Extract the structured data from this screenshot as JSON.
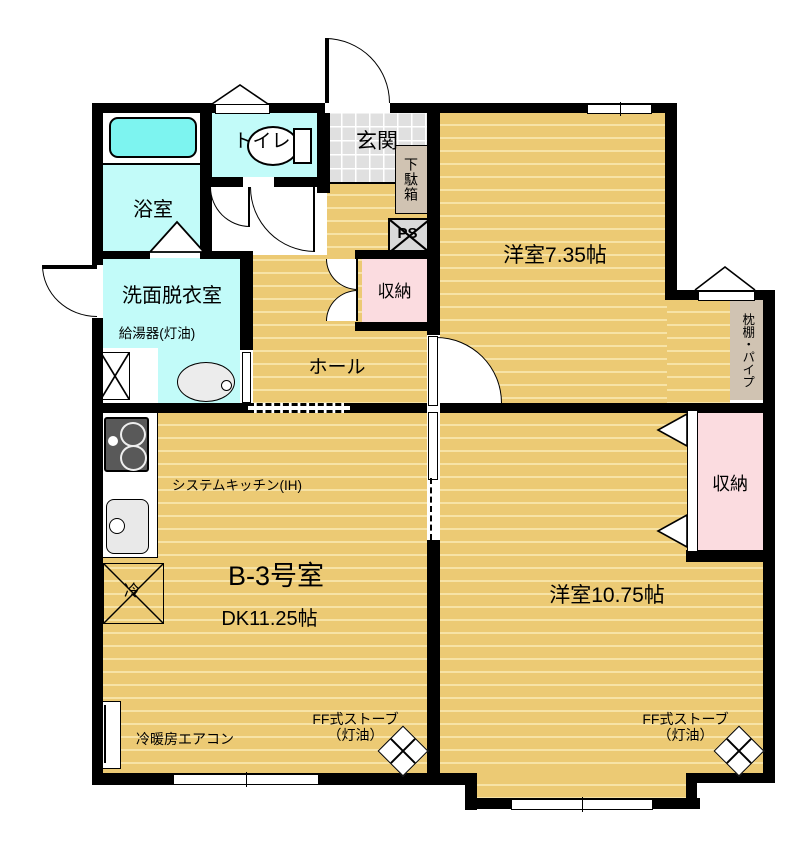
{
  "labels": {
    "bath": "浴室",
    "toilet": "トイレ",
    "entrance": "玄関",
    "shoe_cabinet": "下駄箱",
    "pipe_space": "PS",
    "storage_upper": "収納",
    "washroom": "洗面脱衣室",
    "water_heater": "給湯器(灯油)",
    "hall": "ホール",
    "western_room_1": "洋室7.35帖",
    "shelf_pipe": "枕棚・パイプ",
    "system_kitchen": "システムキッチン(IH)",
    "refrigerator": "冷",
    "unit_name": "B-3号室",
    "unit_size": "DK11.25帖",
    "storage_right": "収納",
    "western_room_2": "洋室10.75帖",
    "aircon": "冷暖房エアコン",
    "stove": "FF式ストーブ",
    "stove_fuel": "（灯油）"
  },
  "colors": {
    "wall": "#000000",
    "wood_floor": "#ecca74",
    "wood_stripe": "#f7e3a6",
    "wet_room_cyan": "#c2fbf9",
    "bathtub_cyan": "#7df4f0",
    "storage_pink": "#fbdce0",
    "entrance_tile_gray": "#e0e0e0",
    "shelf_tan": "#d0c3b2"
  }
}
